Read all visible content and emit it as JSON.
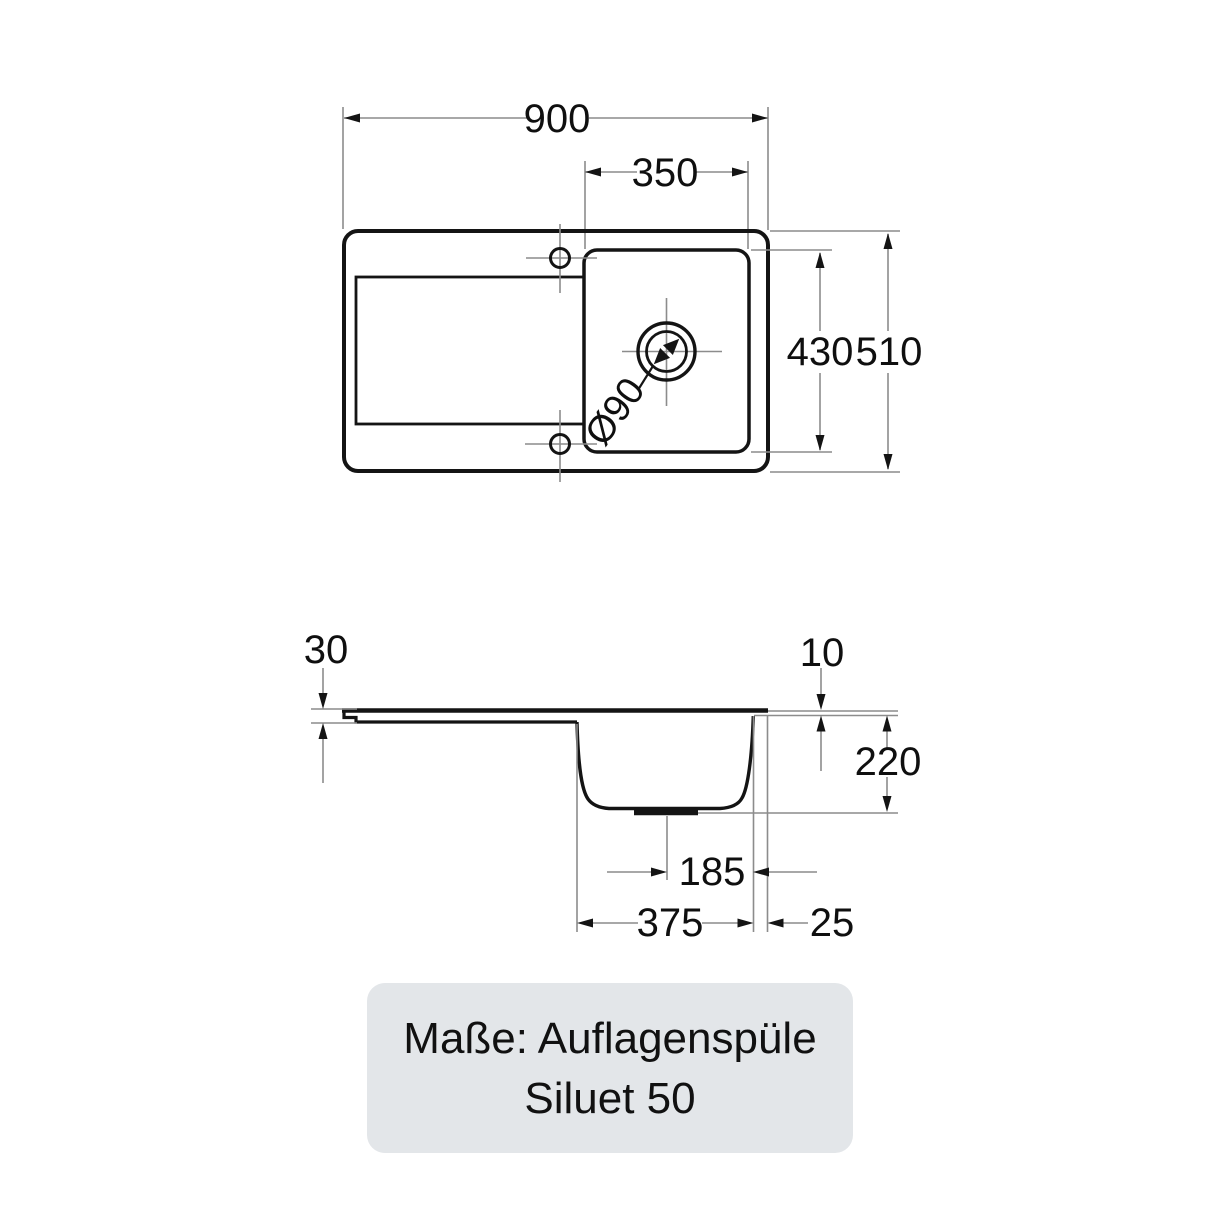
{
  "colors": {
    "background": "#ffffff",
    "outline": "#141414",
    "thin_line": "#8c8c8c",
    "text": "#0f0f0f",
    "caption_bg": "#e3e6e9"
  },
  "top_view": {
    "overall_width": "900",
    "bowl_width": "350",
    "bowl_depth": "430",
    "overall_depth": "510",
    "drain_diameter": "Ø90"
  },
  "side_view": {
    "left_rim_height": "30",
    "right_rim_height": "10",
    "bowl_height": "220",
    "drain_to_edge": "185",
    "bowl_outer_width": "375",
    "rim_overhang": "25"
  },
  "caption": {
    "line1": "Maße: Auflagenspüle",
    "line2": "Siluet 50"
  }
}
